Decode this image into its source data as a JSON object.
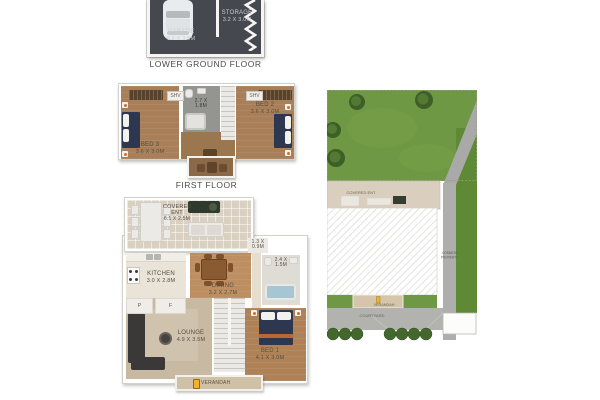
{
  "lower_ground_floor": {
    "title": "LOWER GROUND FLOOR",
    "garage": {
      "name": "GARAGE",
      "dims": "6.2 X 3.5M"
    },
    "storage": {
      "name": "STORAGE",
      "dims": "3.2 X 3.0M"
    }
  },
  "first_floor": {
    "title": "FIRST FLOOR",
    "bed3": {
      "name": "BED 3",
      "dims": "3.6 X 3.0M"
    },
    "bed2": {
      "name": "BED 2",
      "dims": "3.6 X 3.0M"
    },
    "bathroom": {
      "dims": "2.7 X 1.8M"
    },
    "shv_left": "SHV",
    "shv_right": "SHV"
  },
  "ground_floor": {
    "covered_ent": {
      "name": "COVERED ENT",
      "dims": "6.1 X 2.5M"
    },
    "kitchen": {
      "name": "KITCHEN",
      "dims": "3.0 X 2.8M"
    },
    "dining": {
      "name": "DINING",
      "dims": "3.2 X 2.7M"
    },
    "lounge": {
      "name": "LOUNGE",
      "dims": "4.9 X 3.5M"
    },
    "bed1": {
      "name": "BED 1",
      "dims": "4.1 X 3.0M"
    },
    "bathroom": {
      "dims": "2.4 X 1.5M"
    },
    "wc": {
      "dims": "1.3 X 0.9M"
    },
    "pantry": "P",
    "fridge": "F",
    "verandah": "VERANDAH"
  },
  "site_plan": {
    "covered_ent": "COVERED ENT",
    "verandah": "VERANDAH",
    "courtyard": "COURTYARD",
    "common_property_line1": "COMMON",
    "common_property_line2": "PROPERTY"
  },
  "colors": {
    "wall": "#ffffff",
    "garage_floor": "#45484e",
    "wood_floor": "#a87f59",
    "hall_floor": "#9b7750",
    "bath_floor": "#949590",
    "tile_floor": "#d9d0c1",
    "carpet_floor": "#c8b9a3",
    "lawn": "#6f9844",
    "path_gray": "#a9a9a7",
    "bed_navy": "#2d3850",
    "accent_orange": "#d4702c",
    "lantern_yellow": "#f2b32a",
    "tub_blue": "#a6c6d4"
  }
}
